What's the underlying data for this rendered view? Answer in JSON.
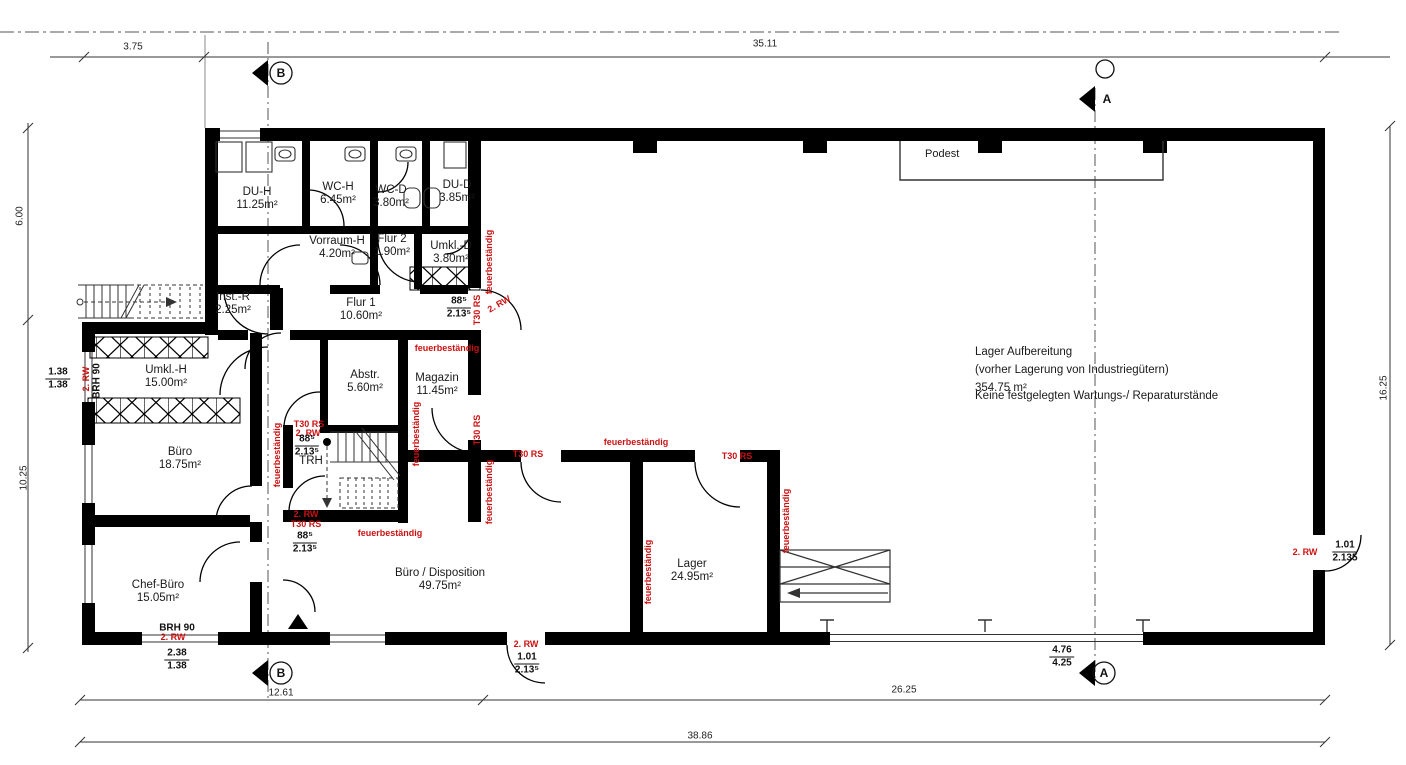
{
  "plan": {
    "hall": {
      "line1": "Lager Aufbereitung",
      "line2": "(vorher Lagerung von Industriegütern)",
      "line3": "354.75 m²",
      "note": "Keine festgelegten Wartungs-/ Reparaturstände"
    },
    "podest_label": "Podest",
    "section_markers": {
      "a": "A",
      "b": "B"
    }
  },
  "colors": {
    "wall": "#000000",
    "annotation_red": "#cc1111",
    "line": "#333333"
  },
  "rooms": [
    {
      "name": "DU-H",
      "area": "11.25m²",
      "x": 257,
      "y": 192
    },
    {
      "name": "WC-H",
      "area": "6.45m²",
      "x": 338,
      "y": 187
    },
    {
      "name": "WC-D",
      "area": "3.80m²",
      "x": 391,
      "y": 190
    },
    {
      "name": "DU-D",
      "area": "3.85m²",
      "x": 457,
      "y": 185
    },
    {
      "name": "Vorraum-H",
      "area": "4.20m²",
      "x": 337,
      "y": 241
    },
    {
      "name": "Flur 2",
      "area": "1.90m²",
      "x": 392,
      "y": 239
    },
    {
      "name": "Umkl.-D",
      "area": "3.80m²",
      "x": 451,
      "y": 246
    },
    {
      "name": "Inst.-R",
      "area": "2.25m²",
      "x": 233,
      "y": 297
    },
    {
      "name": "Flur 1",
      "area": "10.60m²",
      "x": 361,
      "y": 303
    },
    {
      "name": "Umkl.-H",
      "area": "15.00m²",
      "x": 166,
      "y": 370
    },
    {
      "name": "Abstr.",
      "area": "5.60m²",
      "x": 365,
      "y": 375
    },
    {
      "name": "Magazin",
      "area": "11.45m²",
      "x": 437,
      "y": 378
    },
    {
      "name": "Büro",
      "area": "18.75m²",
      "x": 180,
      "y": 452
    },
    {
      "name": "TRH",
      "area": "",
      "x": 311,
      "y": 461
    },
    {
      "name": "Chef-Büro",
      "area": "15.05m²",
      "x": 158,
      "y": 585
    },
    {
      "name": "Büro / Disposition",
      "area": "49.75m²",
      "x": 440,
      "y": 573
    },
    {
      "name": "Lager",
      "area": "24.95m²",
      "x": 692,
      "y": 564
    }
  ],
  "dimensions": [
    {
      "t": "3.75",
      "x": 133,
      "y": 47
    },
    {
      "t": "35.11",
      "x": 765,
      "y": 44
    },
    {
      "t": "6.00",
      "x": 20,
      "y": 216,
      "r": -90
    },
    {
      "t": "10.25",
      "x": 24,
      "y": 478,
      "r": -90
    },
    {
      "t": "16.25",
      "x": 1384,
      "y": 388,
      "r": -90
    },
    {
      "t": "12.61",
      "x": 281,
      "y": 693
    },
    {
      "t": "26.25",
      "x": 904,
      "y": 690
    },
    {
      "t": "38.86",
      "x": 700,
      "y": 736
    }
  ],
  "fractions": [
    {
      "n": "dim-window-left",
      "top": "1.38",
      "bot": "1.38",
      "x": 58,
      "y": 379
    },
    {
      "n": "dim-window-chef",
      "top": "2.38",
      "bot": "1.38",
      "x": 177,
      "y": 660
    },
    {
      "n": "door-flur1",
      "top": "88⁵",
      "bot": "2.13⁵",
      "x": 459,
      "y": 308
    },
    {
      "n": "door-trh-top",
      "top": "88⁵",
      "bot": "2.13⁵",
      "x": 307,
      "y": 446
    },
    {
      "n": "door-trh-bottom",
      "top": "88⁵",
      "bot": "2.13⁵",
      "x": 305,
      "y": 543
    },
    {
      "n": "door-entrance",
      "top": "1.01",
      "bot": "2.13⁵",
      "x": 527,
      "y": 664
    },
    {
      "n": "door-east",
      "top": "1.01",
      "bot": "2.135",
      "x": 1345,
      "y": 552
    },
    {
      "n": "gate-opening",
      "top": "4.76",
      "bot": "4.25",
      "x": 1062,
      "y": 657
    }
  ],
  "annotations": [
    {
      "t": "feuerbeständig",
      "x": 489,
      "y": 262,
      "r": -90
    },
    {
      "t": "T30 RS",
      "x": 477,
      "y": 310,
      "r": -90
    },
    {
      "t": "2. RW",
      "x": 499,
      "y": 304,
      "r": -30
    },
    {
      "t": "feuerbeständig",
      "x": 447,
      "y": 348
    },
    {
      "t": "feuerbeständig",
      "x": 416,
      "y": 434,
      "r": -90
    },
    {
      "t": "T30 RS",
      "x": 309,
      "y": 424
    },
    {
      "t": "2. RW",
      "x": 308,
      "y": 433
    },
    {
      "t": "feuerbeständig",
      "x": 277,
      "y": 455,
      "r": -90
    },
    {
      "t": "2. RW",
      "x": 306,
      "y": 514
    },
    {
      "t": "T30 RS",
      "x": 306,
      "y": 524
    },
    {
      "t": "feuerbeständig",
      "x": 390,
      "y": 533
    },
    {
      "t": "T30 RS",
      "x": 477,
      "y": 430,
      "r": -90
    },
    {
      "t": "T30 RS",
      "x": 528,
      "y": 454
    },
    {
      "t": "feuerbeständig",
      "x": 489,
      "y": 492,
      "r": -90
    },
    {
      "t": "feuerbeständig",
      "x": 636,
      "y": 442
    },
    {
      "t": "T30 RS",
      "x": 737,
      "y": 456
    },
    {
      "t": "feuerbeständig",
      "x": 648,
      "y": 572,
      "r": -90
    },
    {
      "t": "feuerbeständig",
      "x": 786,
      "y": 521,
      "r": -90
    },
    {
      "t": "2. RW",
      "x": 1305,
      "y": 552
    },
    {
      "t": "2. RW",
      "x": 526,
      "y": 644
    },
    {
      "t": "2. RW",
      "x": 86,
      "y": 379,
      "r": -90
    },
    {
      "t": "2. RW",
      "x": 173,
      "y": 637
    }
  ],
  "labels_black": [
    {
      "t": "BRH 90",
      "x": 97,
      "y": 381,
      "r": -90
    },
    {
      "t": "BRH 90",
      "x": 177,
      "y": 628
    }
  ]
}
